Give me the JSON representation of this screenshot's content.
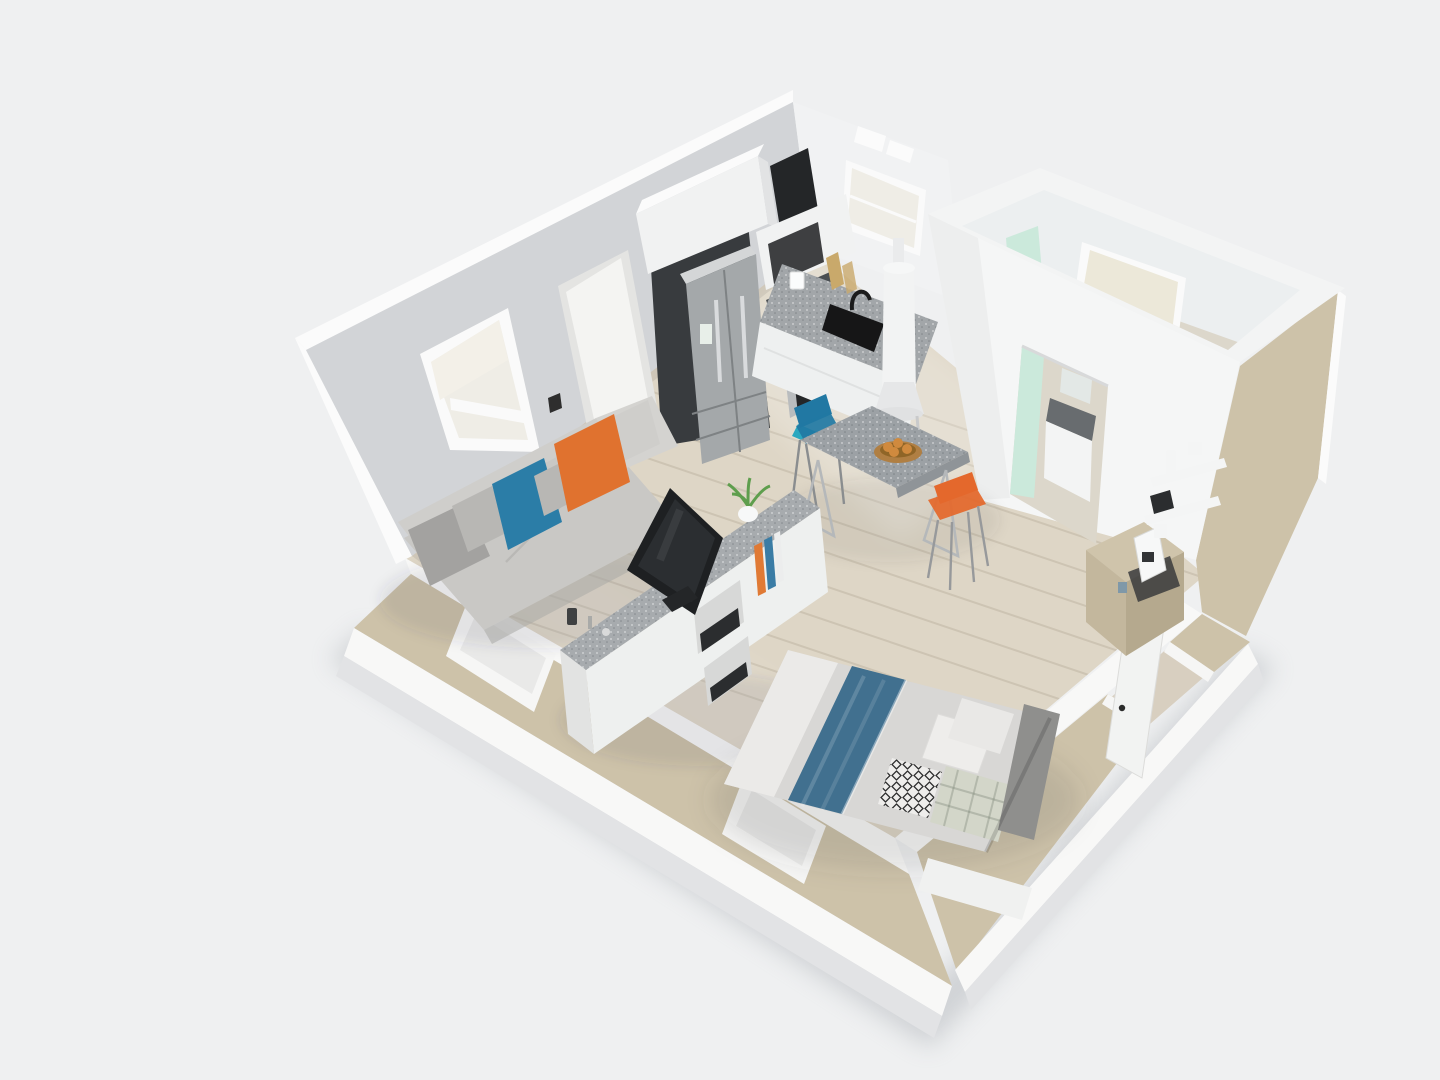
{
  "scene": {
    "kind": "isometric-3d-floorplan-render",
    "subject": "studio apartment cutaway viewed from above",
    "areas": [
      {
        "id": "living",
        "items": [
          "sofa",
          "gray-pillows",
          "blue-pillow",
          "orange-pillow",
          "media-island",
          "tv",
          "potted-plant",
          "candles"
        ]
      },
      {
        "id": "kitchen",
        "items": [
          "refrigerator",
          "upper-cabinets",
          "wall-oven",
          "range-cooktop",
          "countertop",
          "sink",
          "faucet",
          "cutting-boards",
          "window",
          "utility-column",
          "teal-mat"
        ]
      },
      {
        "id": "dining",
        "items": [
          "speckled-table",
          "blue-chair",
          "orange-stool",
          "fruit-bowl",
          "cone-lamp"
        ]
      },
      {
        "id": "bathroom",
        "items": [
          "open-top-room",
          "mint-glass-partition",
          "shower-head",
          "window",
          "vanity",
          "mirror",
          "doorway"
        ]
      },
      {
        "id": "sleeping",
        "items": [
          "bed",
          "duvet",
          "blue-throw",
          "white-pillows",
          "diamond-pillow",
          "plaid-blanket",
          "gray-bolster",
          "foot-bench"
        ]
      },
      {
        "id": "entry",
        "items": [
          "open-door",
          "door-handles",
          "credenza",
          "coffee-maker",
          "wall-shelves"
        ]
      }
    ]
  },
  "colors": {
    "background": "#eff0f1",
    "bldg_shadow": "#a9adb3",
    "floor_wood": "#ded6c6",
    "floor_light": "#ece5d7",
    "wall_edge_white": "#fbfbfb",
    "wall_gray": "#d2d4d7",
    "wall_white": "#f1f2f3",
    "baseboard_white": "#f8f8f7",
    "wall_tan": "#cdc2a9",
    "wall_tan_dark": "#bfb39a",
    "wall_gray_lower": "#e2e3e5",
    "window_frame": "#fafafa",
    "window_pane": "#efede6",
    "window_shade": "#f3f0e8",
    "door_frame": "#e4e4e2",
    "door_panel": "#f4f4f2",
    "switch_dark": "#2e2e2e",
    "kitchen_panel_dark": "#383b3e",
    "cabinet_white": "#f1f2f2",
    "cabinet_top_white": "#fbfbfb",
    "cabinet_shadow": "#e2e3e4",
    "appliance_dark": "#242628",
    "fridge_steel": "#a4a8aa",
    "fridge_top": "#d4d6d7",
    "fridge_lines": "#7e8284",
    "fridge_handle": "#d9dbdd",
    "range_metal": "#b9bcbe",
    "cooktop_dark": "#4b4f52",
    "counter_top": "#a2a6a9",
    "counter_white": "#eef0f0",
    "sink_black": "#161617",
    "board_wood": "#c9a96b",
    "heater_white": "#f2f3f3",
    "heater_base": "#e6e7e8",
    "mat_teal": "#2ba8bf",
    "bath_rim": "#f3f4f4",
    "interior_shade": "#eceff0",
    "bath_front": "#f5f6f6",
    "bath_mint": "#cbe9db",
    "bath_window_pane": "#ece8d9",
    "shower_black": "#1b1b1b",
    "bath_floor": "#dcd7cb",
    "vanity_top": "#686c6f",
    "vanity_white": "#f3f4f4",
    "mirror_glass": "#e3e8e6",
    "credenza_tan": "#c3b79d",
    "credenza_top": "#cfc4ab",
    "credenza_side": "#b5a98e",
    "shelf_white": "#f4f5f5",
    "device_dark": "#2b2d2f",
    "pot_white": "#f7f8f8",
    "tray_dark": "#3a3b3c",
    "cup_blue": "#7f98a8",
    "table_top": "#9ca1a5",
    "table_edge": "#8f9498",
    "leg_steel": "#b5b8ba",
    "chair_blue": "#2178a3",
    "stool_orange": "#e4682c",
    "bowl_bronze": "#b07f43",
    "bowl_inner": "#8f6527",
    "fruit_orange": "#d08a3e",
    "sofa_gray": "#c9c8c5",
    "sofa_back": "#cfcecb",
    "sofa_arm_light": "#d4d3d0",
    "sofa_shadow": "#aaa9a6",
    "pillow_blue": "#2b7da7",
    "pillow_orange": "#e0722f",
    "pillow_gray": "#a3a2a0",
    "pillow_light": "#b8b7b4",
    "island_top": "#a7abae",
    "island_body": "#eef0ef",
    "island_end": "#e2e3e2",
    "shelf_hole": "#d7d8d7",
    "book_orange": "#e07a35",
    "book_blue": "#3a7ca5",
    "book_white": "#eceded",
    "tv_black": "#1e2022",
    "tv_screen": "#2b2e31",
    "plant_green": "#5e9e4d",
    "duvet_gray": "#d8d7d5",
    "sheet_white": "#eeedeb",
    "throw_blue": "#41708f",
    "pillow_white2": "#e9e8e6",
    "blanket_plaid": "#d3d6c9",
    "bolster_gray": "#8f8f8d",
    "bench_white": "#f0f1f0",
    "leaf_door": "#f2f3f2",
    "handle_dark": "#2b2b2b",
    "jamb_white": "#f6f6f5",
    "entry_floor": "#d8cfc0"
  }
}
